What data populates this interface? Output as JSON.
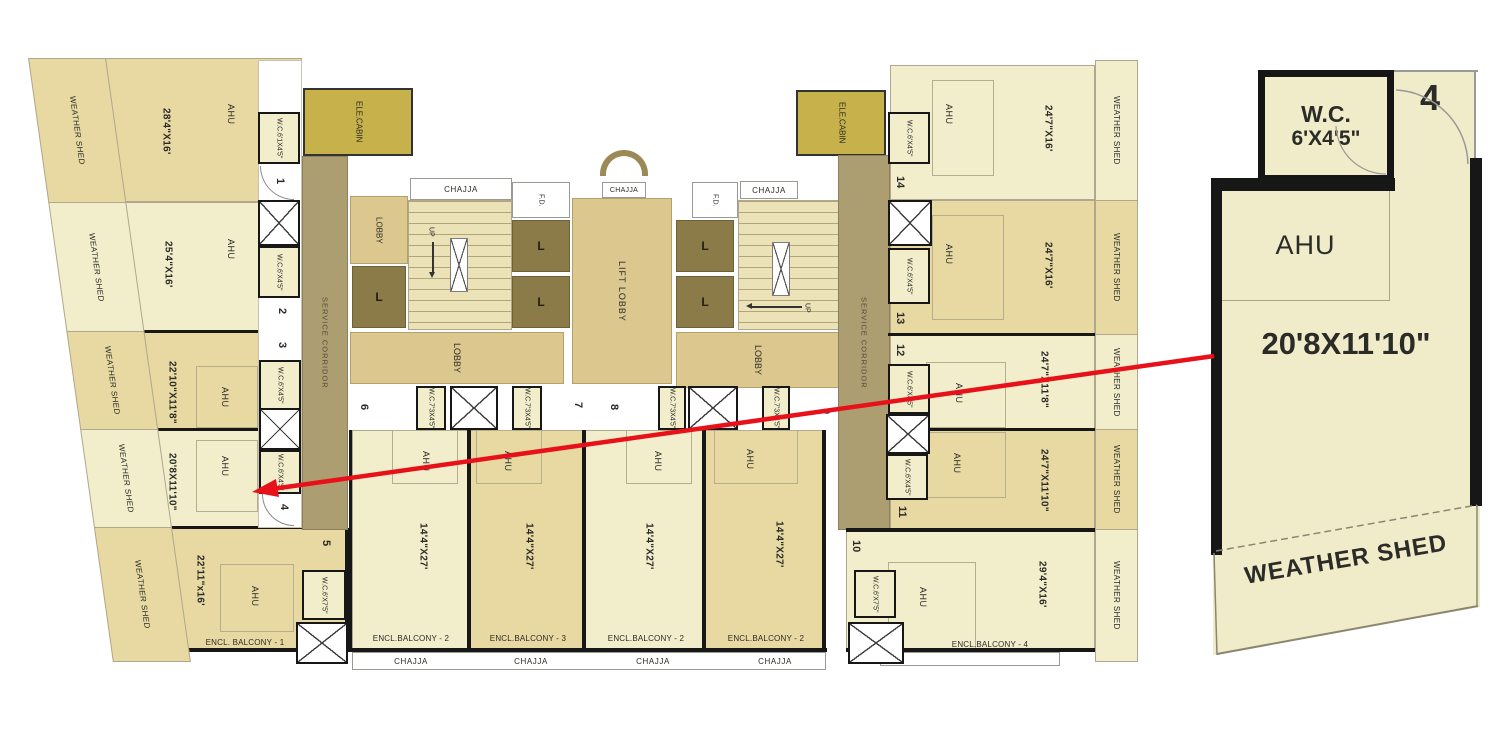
{
  "colors": {
    "unit_light": "#f2edcb",
    "unit_dark": "#e7d9a1",
    "corridor": "#ad9e72",
    "lobby": "#dcc88e",
    "stairs": "#ece2b8",
    "lift_shaft": "#8a7b48",
    "ele_cabin": "#c7b14a",
    "wall": "#171717",
    "thin_line": "#b0a78e",
    "arrow_red": "#e8111a",
    "cream": "#f0ebc9",
    "text_dark": "#2b2b28"
  },
  "labels": {
    "weather_shed": "WEATHER SHED",
    "ahu": "AHU",
    "wc": "W.C.",
    "chajja": "CHAJJA",
    "lobby": "LOBBY",
    "lift_lobby": "LIFT LOBBY",
    "service_corridor": "SERVICE CORRIDOR",
    "ele_l1": "ELE.",
    "ele_l2": "CABIN",
    "fd": "F.D.",
    "up": "UP",
    "lift": "L"
  },
  "left_units": [
    {
      "number": "1",
      "size": "28'4\"X16'",
      "wc_size": "6'1X4'5\""
    },
    {
      "number": "2",
      "size": "25'4\"X16'",
      "wc_size": "6'X4'5\""
    },
    {
      "number": "3",
      "size": "22'10\"X11'8\"",
      "wc_size": "6'X4'5\""
    },
    {
      "number": "4",
      "size": "20'8X11'10\"",
      "wc_size": "6'X4'5\""
    },
    {
      "number": "5",
      "size": "22'11\"x16'",
      "wc_size": "6'X7'5\"",
      "balcony": "ENCL. BALCONY - 1"
    }
  ],
  "bottom_units": [
    {
      "number": "6",
      "size": "14'4\"X27'",
      "wc_size": "7'3X4'5\"",
      "balcony": "ENCL.BALCONY - 2"
    },
    {
      "number": "7",
      "size": "14'4\"X27'",
      "wc_size": "7'3X4'5\"",
      "balcony": "ENCL.BALCONY - 3"
    },
    {
      "number": "8",
      "size": "14'4\"X27'",
      "wc_size": "7'3X4'5\"",
      "balcony": "ENCL.BALCONY - 2"
    },
    {
      "number": "9",
      "size": "14'4\"X27'",
      "wc_size": "7'3X4'5\"",
      "balcony": "ENCL.BALCONY - 2"
    }
  ],
  "right_units": [
    {
      "number": "10",
      "size": "29'4\"X16'",
      "wc_size": "6'X7'5\"",
      "balcony": "ENCL.BALCONY - 4"
    },
    {
      "number": "11",
      "size": "24'7\"X11'10\"",
      "wc_size": "6'X4'5\""
    },
    {
      "number": "12",
      "size": "24'7\"X11'8\"",
      "wc_size": "6'X4'5\""
    },
    {
      "number": "13",
      "size": "24'7\"X16'",
      "wc_size": "6'X4'5\""
    },
    {
      "number": "14",
      "size": "24'7\"X16'",
      "wc_size": "6'X4'5\""
    }
  ],
  "detail_panel": {
    "unit_number": "4",
    "wc_label": "W.C.",
    "wc_size": "6'X4'5\"",
    "ahu": "AHU",
    "size": "20'8X11'10\"",
    "weather_shed": "WEATHER SHED"
  }
}
